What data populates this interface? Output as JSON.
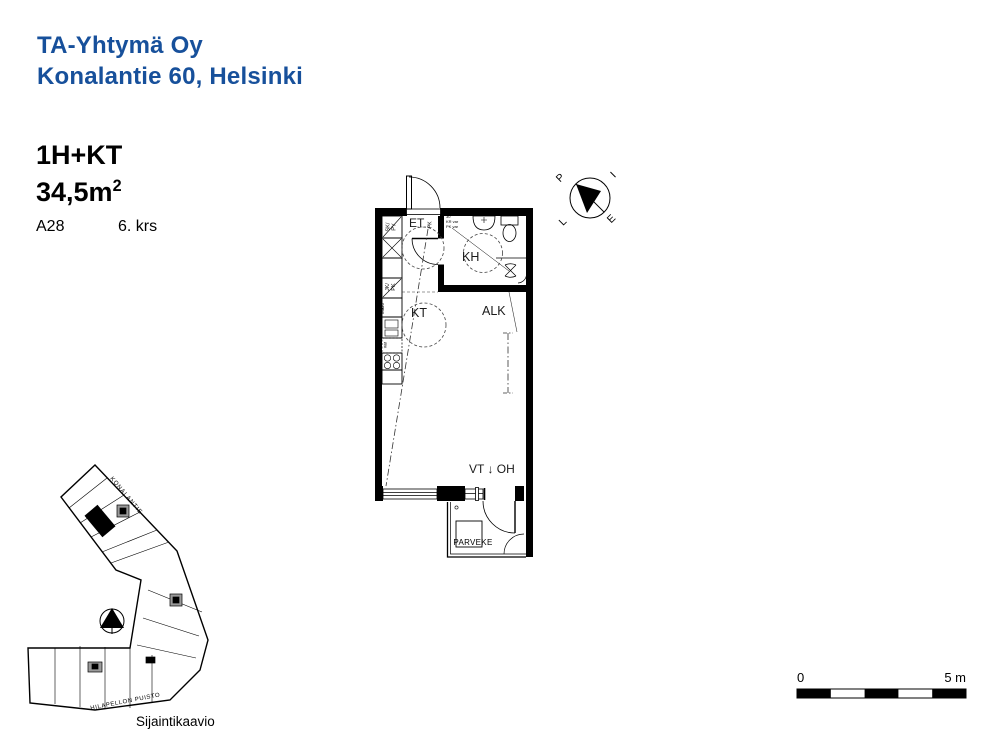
{
  "header": {
    "company": "TA-Yhtymä Oy",
    "address": "Konalantie 60, Helsinki"
  },
  "unit": {
    "type": "1H+KT",
    "area": "34,5m",
    "area_sup": "2",
    "code": "A28",
    "floor": "6. krs"
  },
  "rooms": {
    "entrance": "ET",
    "bathroom": "KH",
    "kitchenette": "KT",
    "alcove": "ALK",
    "balcony": "PARVEKE",
    "vt_oh": "VT ↓ OH"
  },
  "fixtures": {
    "cleaning_closet": "SK/\nPY",
    "fridge_freezer": "JK/\nPK",
    "microwave": "Mikro",
    "dishwasher_res": "APK\nvar",
    "entry_cabinet": "PK",
    "bath_res": "30\nKR var\nPK var"
  },
  "compass": {
    "north": "P",
    "east": "I",
    "south": "E",
    "west": "L"
  },
  "siteplan": {
    "street": "KONALANTIE",
    "park": "HILAPELLON PUISTO",
    "caption": "Sijaintikaavio"
  },
  "scalebar": {
    "zero": "0",
    "five": "5 m"
  },
  "colors": {
    "brand": "#17509b",
    "line": "#000000",
    "stair_gray": "#9a9a9a"
  }
}
